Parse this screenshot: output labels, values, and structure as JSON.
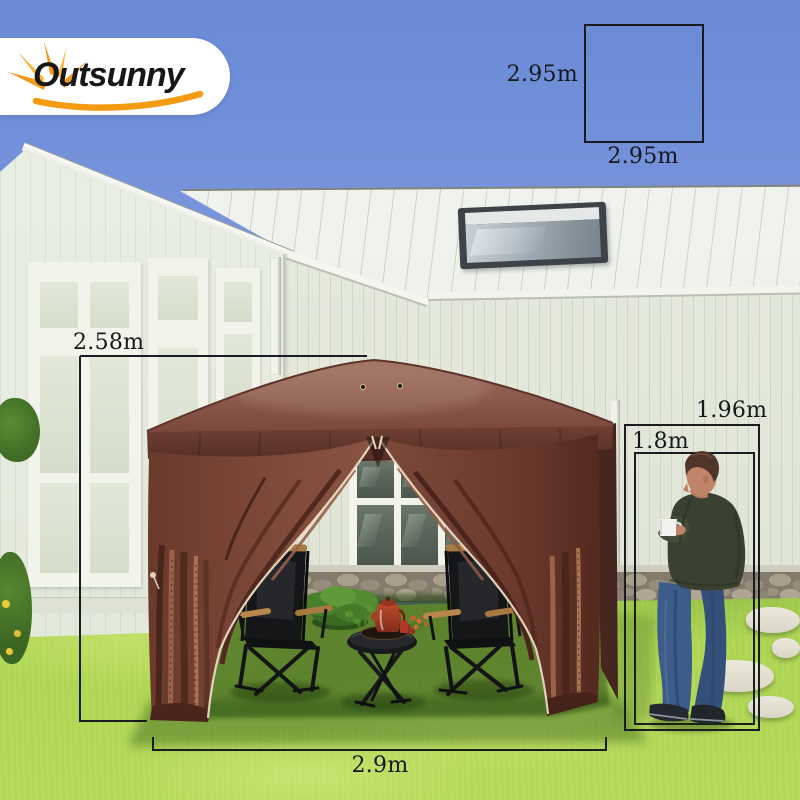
{
  "brand": {
    "logo_text": "Outsunny"
  },
  "size_diagram": {
    "height_label": "2.95m",
    "width_label": "2.95m"
  },
  "annotations": {
    "canopy_height": "2.58m",
    "canopy_width": "2.9m",
    "eave_height": "1.96m",
    "person_height": "1.8m"
  },
  "colors": {
    "sky_blue": "#7b97de",
    "house_white": "#e7ecdf",
    "roof_white": "#f0f2ec",
    "canopy_brown": "#7b493c",
    "canopy_dark_brown": "#5a3128",
    "grass_green": "#9bc848",
    "dimension_line": "#1b1c20",
    "logo_yellow": "#f39c11",
    "shirt_olive": "#3b4130",
    "jeans_blue": "#3d5c8a"
  }
}
